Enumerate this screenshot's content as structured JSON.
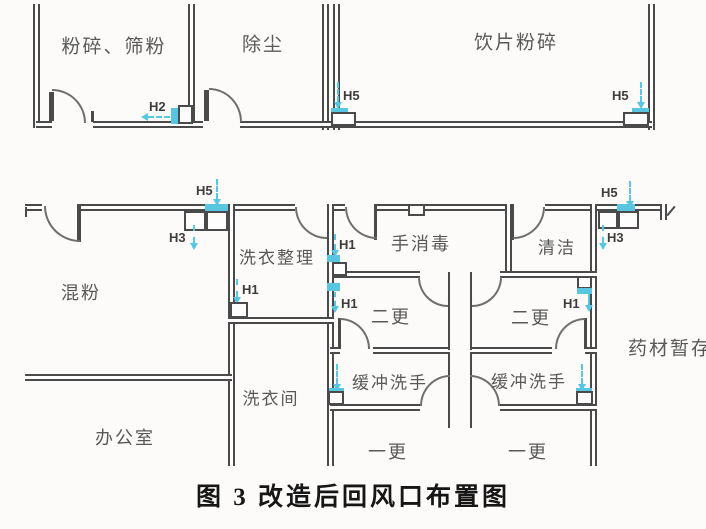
{
  "figure": {
    "caption": "图 3 改造后回风口布置图"
  },
  "colors": {
    "wall": "#4a4a4a",
    "vent_accent": "#58c6e0",
    "label_text": "#585858"
  },
  "rooms": {
    "crushing_sieving": "粉碎、筛粉",
    "dust_removal": "除尘",
    "slice_crushing": "饮片粉碎",
    "powder_mixing": "混粉",
    "laundry_sorting": "洗衣整理",
    "hand_disinfection": "手消毒",
    "cleaning": "清洁",
    "second_change_left": "二更",
    "second_change_right": "二更",
    "laundry_room": "洗衣间",
    "buffer_handwash_left": "缓冲洗手",
    "buffer_handwash_right": "缓冲洗手",
    "office": "办公室",
    "first_change_left": "一更",
    "first_change_right": "一更",
    "herb_storage": "药材暂存"
  },
  "vents": {
    "h2": "H2",
    "h5_slice_left": "H5",
    "h5_slice_right": "H5",
    "h5_mixing_wall": "H5",
    "h3_mixing_wall": "H3",
    "h5_east_wall": "H5",
    "h3_east_wall": "H3",
    "h1_laundry_wall": "H1",
    "h1_junction_upper": "H1",
    "h1_junction_lower": "H1",
    "h1_east_wall": "H1"
  }
}
